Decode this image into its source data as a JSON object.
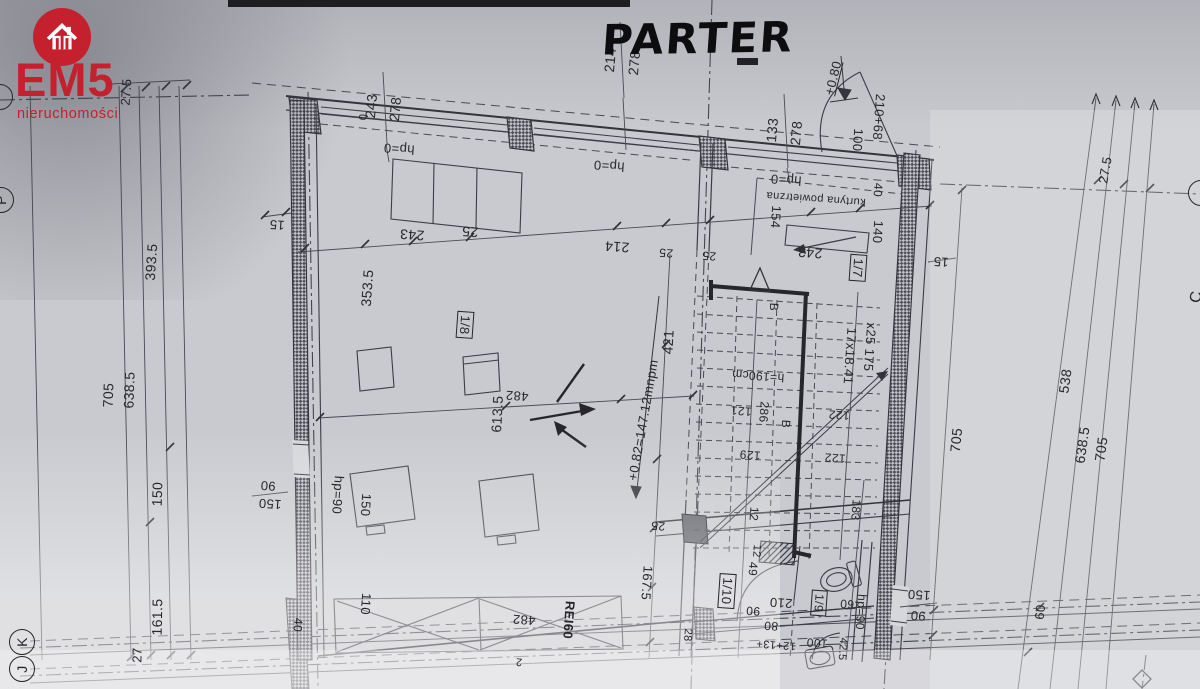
{
  "title": {
    "text": "PARTER"
  },
  "branding": {
    "logo_text": "EM5",
    "logo_subtext": "nieruchomości",
    "brand_color": "#c5202e",
    "icon": "house-icon"
  },
  "grid_bubbles": {
    "bottom_left": [
      "K",
      "J"
    ],
    "left_edge": "P",
    "right_edge": "C"
  },
  "rooms": [
    "1/7",
    "1/8",
    "1/9",
    "1/10"
  ],
  "notes": {
    "air_curtain": "kurtyna powietrzna",
    "fire_rating": "REI60",
    "stairs_spec": "17x18.41 x25 175",
    "floor_level": "+0.82=147.12mnpm",
    "entry_level": "+0.80"
  },
  "labels": [
    {
      "t": "27.5",
      "x": 126,
      "y": 92,
      "r": -86,
      "s": 13
    },
    {
      "t": "393.5",
      "x": 151,
      "y": 262,
      "r": -86,
      "s": 14
    },
    {
      "t": "705",
      "x": 108,
      "y": 395,
      "r": -88,
      "s": 14
    },
    {
      "t": "638.5",
      "x": 129,
      "y": 390,
      "r": -88,
      "s": 14
    },
    {
      "t": "150",
      "x": 157,
      "y": 494,
      "r": -88,
      "s": 14
    },
    {
      "t": "161.5",
      "x": 157,
      "y": 617,
      "r": -89,
      "s": 14
    },
    {
      "t": "27",
      "x": 137,
      "y": 655,
      "r": -89,
      "s": 13
    },
    {
      "t": "15",
      "x": 277,
      "y": 225,
      "r": 184,
      "s": 13
    },
    {
      "t": "90",
      "x": 268,
      "y": 486,
      "r": 184,
      "s": 13
    },
    {
      "t": "150",
      "x": 270,
      "y": 504,
      "r": 184,
      "s": 13
    },
    {
      "t": "243",
      "x": 371,
      "y": 106,
      "r": -85,
      "s": 14
    },
    {
      "t": "278",
      "x": 395,
      "y": 109,
      "r": -85,
      "s": 14
    },
    {
      "t": "0",
      "x": 364,
      "y": 117,
      "r": -85,
      "s": 11
    },
    {
      "t": "hp=0",
      "x": 399,
      "y": 149,
      "r": 184,
      "s": 13
    },
    {
      "t": "243",
      "x": 412,
      "y": 235,
      "r": 184,
      "s": 14
    },
    {
      "t": "25",
      "x": 470,
      "y": 232,
      "r": 184,
      "s": 14
    },
    {
      "t": "hp=0",
      "x": 609,
      "y": 166,
      "r": 184,
      "s": 13
    },
    {
      "t": "214",
      "x": 617,
      "y": 247,
      "r": 184,
      "s": 14
    },
    {
      "t": "214",
      "x": 610,
      "y": 60,
      "r": -85,
      "s": 14
    },
    {
      "t": "278",
      "x": 634,
      "y": 63,
      "r": -85,
      "s": 14
    },
    {
      "t": "133",
      "x": 772,
      "y": 130,
      "r": -85,
      "s": 14
    },
    {
      "t": "278",
      "x": 796,
      "y": 133,
      "r": -85,
      "s": 14
    },
    {
      "t": "+0.80",
      "x": 833,
      "y": 78,
      "r": -76,
      "s": 13,
      "f": "ul",
      "n": "note-entry-level"
    },
    {
      "t": "100",
      "x": 858,
      "y": 140,
      "r": 94,
      "s": 13
    },
    {
      "t": "210+68",
      "x": 879,
      "y": 117,
      "r": 94,
      "s": 13
    },
    {
      "t": "40",
      "x": 878,
      "y": 190,
      "r": 94,
      "s": 12
    },
    {
      "t": "hp=0",
      "x": 786,
      "y": 180,
      "r": 184,
      "s": 13
    },
    {
      "t": "kurtyna powietrzna",
      "x": 816,
      "y": 198,
      "r": 184,
      "s": 11,
      "n": "note-air-curtain"
    },
    {
      "t": "154",
      "x": 776,
      "y": 217,
      "r": 94,
      "s": 13
    },
    {
      "t": "140",
      "x": 878,
      "y": 232,
      "r": 94,
      "s": 13
    },
    {
      "t": "243",
      "x": 810,
      "y": 253,
      "r": 184,
      "s": 14
    },
    {
      "t": "25",
      "x": 666,
      "y": 253,
      "r": 184,
      "s": 12
    },
    {
      "t": "25",
      "x": 709,
      "y": 256,
      "r": 184,
      "s": 12
    },
    {
      "t": "1/7",
      "x": 858,
      "y": 268,
      "r": 94,
      "s": 13,
      "f": "box",
      "n": "room-tag"
    },
    {
      "t": "15",
      "x": 941,
      "y": 262,
      "r": 184,
      "s": 13
    },
    {
      "t": "353.5",
      "x": 367,
      "y": 288,
      "r": -86,
      "s": 14
    },
    {
      "t": "1/8",
      "x": 465,
      "y": 325,
      "r": 94,
      "s": 13,
      "f": "box",
      "n": "room-tag"
    },
    {
      "t": "613.5",
      "x": 497,
      "y": 414,
      "r": -87,
      "s": 14
    },
    {
      "t": "482",
      "x": 517,
      "y": 396,
      "r": 184,
      "s": 13
    },
    {
      "t": "421",
      "x": 668,
      "y": 342,
      "r": -87,
      "s": 14
    },
    {
      "t": "B",
      "x": 774,
      "y": 307,
      "r": 94,
      "s": 12,
      "n": "section-mark-b"
    },
    {
      "t": "B",
      "x": 786,
      "y": 424,
      "r": 94,
      "s": 12,
      "n": "section-mark-b"
    },
    {
      "t": "17x18.41",
      "x": 850,
      "y": 356,
      "r": 94,
      "s": 13,
      "n": "stairs-spec"
    },
    {
      "t": "x25 175",
      "x": 870,
      "y": 347,
      "r": 94,
      "s": 13,
      "n": "stairs-spec"
    },
    {
      "t": "h=190cm",
      "x": 758,
      "y": 376,
      "r": 184,
      "s": 12
    },
    {
      "t": "121",
      "x": 741,
      "y": 411,
      "r": 184,
      "s": 12
    },
    {
      "t": "286",
      "x": 764,
      "y": 412,
      "r": 94,
      "s": 12
    },
    {
      "t": "129",
      "x": 750,
      "y": 455,
      "r": 184,
      "s": 12
    },
    {
      "t": "122",
      "x": 839,
      "y": 415,
      "r": 184,
      "s": 12
    },
    {
      "t": "122",
      "x": 835,
      "y": 458,
      "r": 184,
      "s": 12
    },
    {
      "t": "+0.82=147.12mnpm",
      "x": 643,
      "y": 420,
      "r": -80,
      "s": 13,
      "n": "note-floor-level"
    },
    {
      "t": "hp=90",
      "x": 338,
      "y": 495,
      "r": 94,
      "s": 13
    },
    {
      "t": "150",
      "x": 366,
      "y": 505,
      "r": 94,
      "s": 13
    },
    {
      "t": "110",
      "x": 366,
      "y": 604,
      "r": 94,
      "s": 13
    },
    {
      "t": "40",
      "x": 298,
      "y": 625,
      "r": 94,
      "s": 12
    },
    {
      "t": "167.5",
      "x": 647,
      "y": 583,
      "r": 94,
      "s": 13
    },
    {
      "t": "25",
      "x": 658,
      "y": 526,
      "r": 184,
      "s": 12
    },
    {
      "t": "12",
      "x": 754,
      "y": 514,
      "r": 94,
      "s": 12
    },
    {
      "t": "12",
      "x": 756,
      "y": 551,
      "r": 94,
      "s": 11
    },
    {
      "t": "49",
      "x": 753,
      "y": 569,
      "r": 94,
      "s": 12
    },
    {
      "t": "183",
      "x": 856,
      "y": 510,
      "r": 94,
      "s": 12
    },
    {
      "t": "1/10",
      "x": 727,
      "y": 591,
      "r": 94,
      "s": 13,
      "f": "box",
      "n": "room-tag"
    },
    {
      "t": "210",
      "x": 781,
      "y": 603,
      "r": 184,
      "s": 13
    },
    {
      "t": "90",
      "x": 753,
      "y": 611,
      "r": 184,
      "s": 12
    },
    {
      "t": "80",
      "x": 771,
      "y": 626,
      "r": 184,
      "s": 12
    },
    {
      "t": "1/9",
      "x": 819,
      "y": 603,
      "r": 94,
      "s": 12,
      "f": "box",
      "n": "room-tag"
    },
    {
      "t": "60",
      "x": 847,
      "y": 604,
      "r": 184,
      "s": 12
    },
    {
      "t": "hp=90",
      "x": 861,
      "y": 612,
      "r": 94,
      "s": 12
    },
    {
      "t": "12+13+",
      "x": 776,
      "y": 644,
      "r": 184,
      "s": 11
    },
    {
      "t": "100",
      "x": 817,
      "y": 643,
      "r": 184,
      "s": 12
    },
    {
      "t": "42.5",
      "x": 842,
      "y": 649,
      "r": 94,
      "s": 11
    },
    {
      "t": "482",
      "x": 524,
      "y": 620,
      "r": 184,
      "s": 13
    },
    {
      "t": "REI60",
      "x": 569,
      "y": 620,
      "r": 94,
      "s": 13,
      "f": "bold",
      "n": "note-fire-rating"
    },
    {
      "t": "2",
      "x": 519,
      "y": 661,
      "r": 184,
      "s": 11
    },
    {
      "t": "28",
      "x": 687,
      "y": 635,
      "r": 94,
      "s": 11
    },
    {
      "t": "150",
      "x": 919,
      "y": 595,
      "r": 184,
      "s": 13
    },
    {
      "t": "90",
      "x": 918,
      "y": 616,
      "r": 184,
      "s": 13
    },
    {
      "t": "538",
      "x": 1065,
      "y": 381,
      "r": -82,
      "s": 14
    },
    {
      "t": "638.5",
      "x": 1082,
      "y": 445,
      "r": -82,
      "s": 14
    },
    {
      "t": "705",
      "x": 1101,
      "y": 449,
      "r": -82,
      "s": 14
    },
    {
      "t": "705",
      "x": 956,
      "y": 440,
      "r": -84,
      "s": 14
    },
    {
      "t": "27.5",
      "x": 1105,
      "y": 170,
      "r": -80,
      "s": 13
    },
    {
      "t": "60",
      "x": 1040,
      "y": 612,
      "r": -84,
      "s": 13
    },
    {
      "t": "K",
      "x": 22,
      "y": 642,
      "r": -90,
      "s": 14,
      "f": "bubble",
      "n": "grid-bubble-k"
    },
    {
      "t": "J",
      "x": 22,
      "y": 669,
      "r": -90,
      "s": 14,
      "f": "bubble",
      "n": "grid-bubble-j"
    },
    {
      "t": "P",
      "x": 1,
      "y": 200,
      "r": -90,
      "s": 14,
      "f": "bubble",
      "n": "grid-bubble-p"
    },
    {
      "t": "",
      "x": 0,
      "y": 97,
      "r": 0,
      "s": 12,
      "f": "bubble",
      "n": "grid-bubble-partial"
    },
    {
      "t": "",
      "x": 1201,
      "y": 193,
      "r": 0,
      "s": 12,
      "f": "bubble",
      "n": "grid-bubble-partial"
    },
    {
      "t": "C",
      "x": 1197,
      "y": 297,
      "r": -80,
      "s": 16,
      "f": "ul",
      "n": "grid-bubble-c"
    }
  ]
}
